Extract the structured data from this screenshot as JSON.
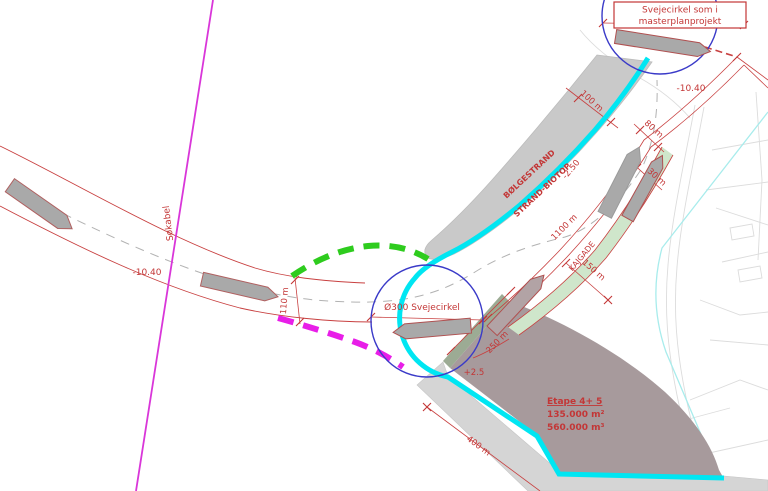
{
  "title_box": {
    "line1": "Svejecirkel som i",
    "line2": "masterplanprojekt"
  },
  "labels": {
    "sokabel": "Søkabel",
    "depth_channel": "-10.40",
    "depth_ne": "-10.40",
    "dim_mouth": "110 m",
    "roundabout_circle": "Ø300 Svejecirkel",
    "level_plus": "+2.5",
    "level_minus": "-2.50",
    "beach_line1": "BØLGESTRAND",
    "beach_line2": "STRAND-BIOTOP",
    "dim_beach_width": "100 m",
    "dim_waterway": "80 m",
    "dim_quay_width": "30 m",
    "dim_quay_length": "1100 m",
    "quay_street": "KAJGADE",
    "dim_150": "150 m",
    "dim_250": "250 m",
    "dim_400": "400 m"
  },
  "etape": {
    "title": "Etape 4+ 5",
    "area": "135.000 m²",
    "volume": "560.000 m³"
  },
  "colors": {
    "annotation_red": "#c33636",
    "sea_cable_magenta": "#d936d9",
    "edge_cyan": "#00e6f2",
    "option_green_dashed": "#2ecc1e",
    "option_magenta_dashed": "#e81ee8",
    "circle_blue": "#3a3ac8",
    "beach_gray": "#c9c9c9",
    "breakwater_gray": "#d5d5d5",
    "etape_mauve": "#a79a9c",
    "quay_green": "#cfe6cb",
    "slope_sage": "#9cab94",
    "background_map_gray": "#dcdcdc",
    "existing_cable_lightcyan": "#a8ecec"
  }
}
